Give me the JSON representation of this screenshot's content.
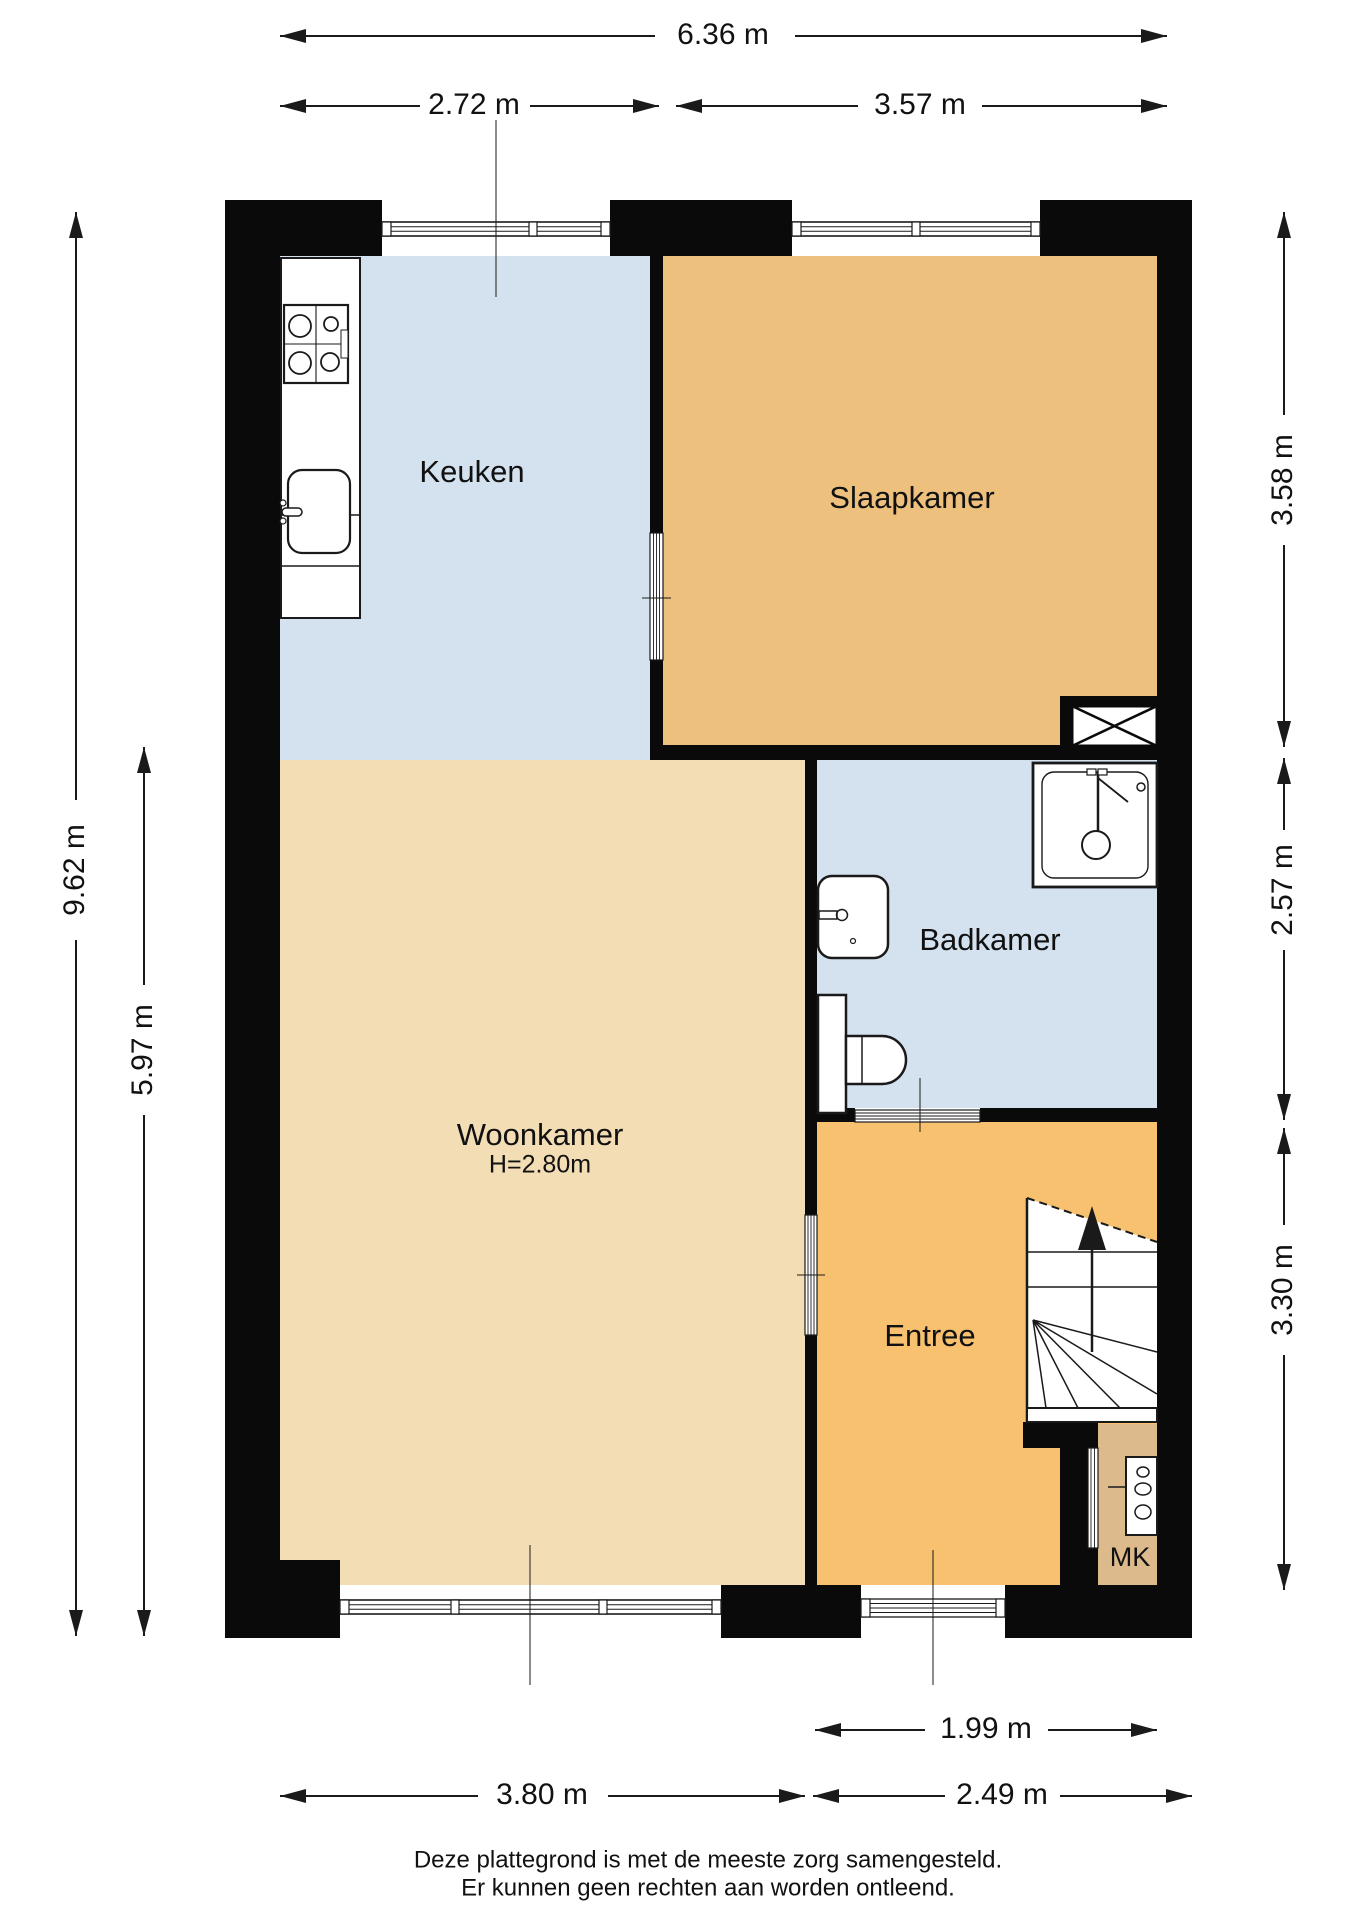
{
  "title": "Plattegrond begane grond",
  "colors": {
    "wall": "#0a0a0a",
    "line": "#1a1a1a",
    "keuken": "#d4e1ef",
    "slaapkamer": "#edc07e",
    "woonkamer": "#f2ddb4",
    "badkamer": "#d4e1ef",
    "entree": "#f7c170",
    "mk": "#dcba8b",
    "fixture": "#ffffff"
  },
  "rooms": {
    "keuken": {
      "label": "Keuken"
    },
    "slaapkamer": {
      "label": "Slaapkamer"
    },
    "woonkamer": {
      "label": "Woonkamer",
      "ceiling_height": "H=2.80m"
    },
    "badkamer": {
      "label": "Badkamer"
    },
    "entree": {
      "label": "Entree"
    },
    "meterkast": {
      "label": "MK"
    }
  },
  "dimensions": {
    "top_total": "6.36 m",
    "top_keuken": "2.72 m",
    "top_slaapkamer": "3.57 m",
    "left_total": "9.62 m",
    "left_woonkamer": "5.97 m",
    "right_slaapkamer": "3.58 m",
    "right_badkamer": "2.57 m",
    "right_entree": "3.30 m",
    "bottom_entree_door": "1.99 m",
    "bottom_woonkamer": "3.80 m",
    "bottom_entree": "2.49 m"
  },
  "footer": {
    "line1": "Deze plattegrond is met de meeste zorg samengesteld.",
    "line2": "Er kunnen geen rechten aan worden ontleend."
  },
  "icons": [
    "stove-icon",
    "kitchen-sink-icon",
    "washbasin-icon",
    "toilet-icon",
    "shower-icon",
    "stairs-up-arrow-icon",
    "ventilation-shaft-icon",
    "meter-panel-icon"
  ]
}
